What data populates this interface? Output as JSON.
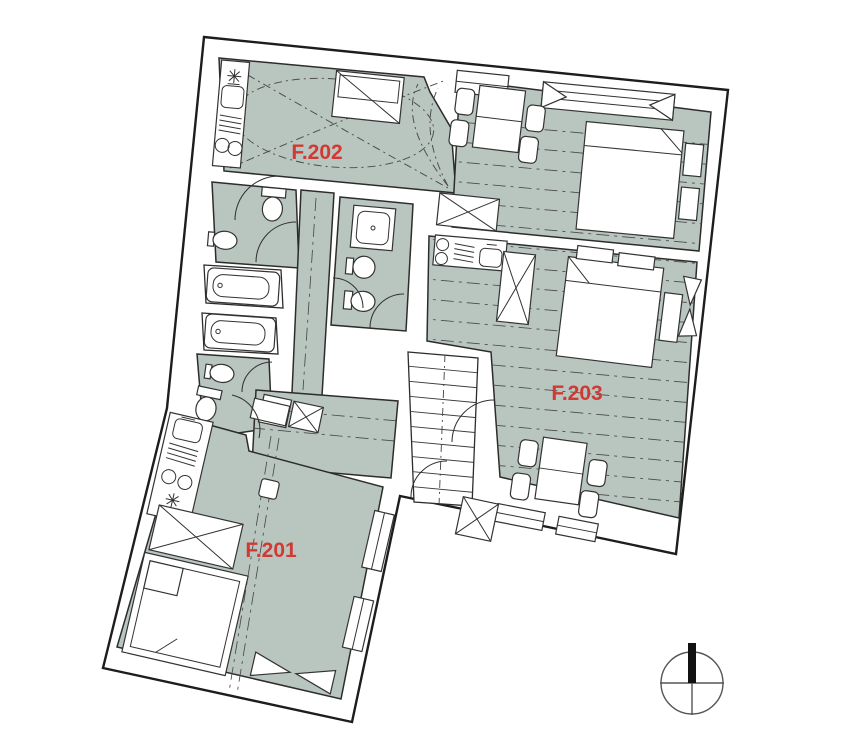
{
  "document": {
    "type": "apartment-floor-plan",
    "floor": "2nd-floor-units"
  },
  "rooms": {
    "f201": {
      "label": "F.201"
    },
    "f202": {
      "label": "F.202"
    },
    "f203": {
      "label": "F.203"
    }
  },
  "colors": {
    "room_fill": "#b9c6bf",
    "wall_line": "#1d1d1d",
    "label_red": "#d13a34",
    "background": "#ffffff",
    "compass_black": "#111111"
  },
  "compass": {
    "name": "north-indicator",
    "direction": "up"
  }
}
